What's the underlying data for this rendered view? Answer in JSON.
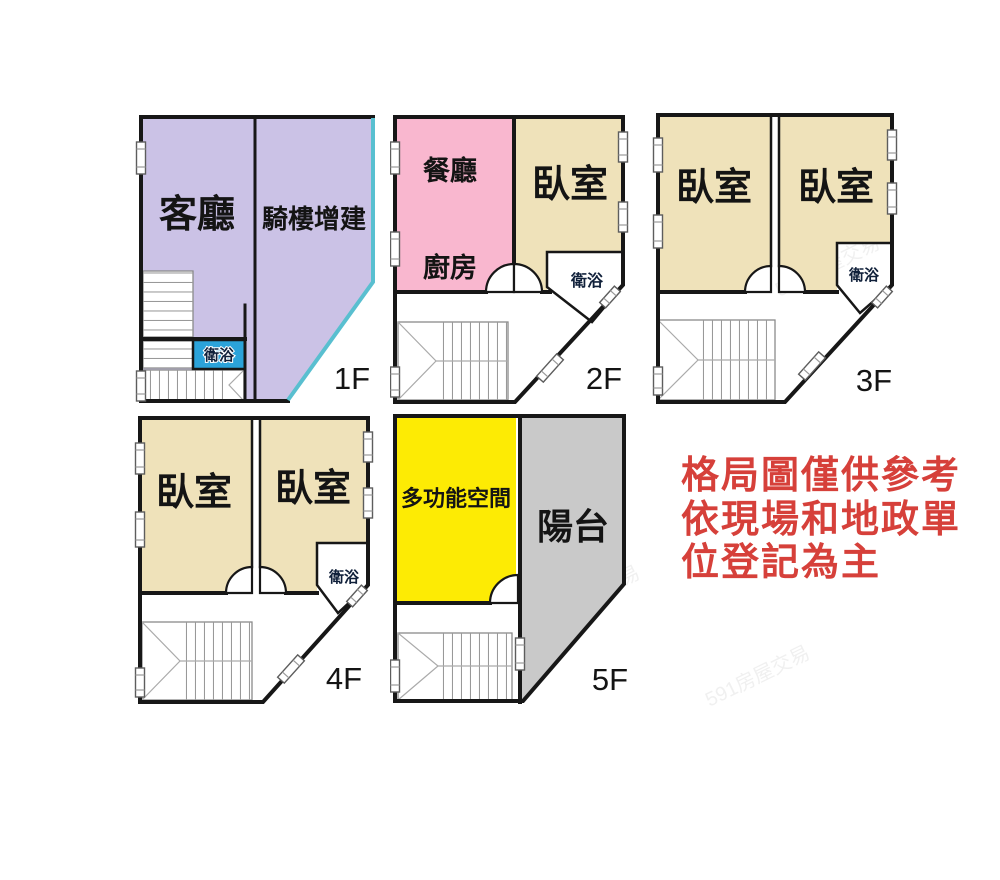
{
  "title": "apartment-floor-plans",
  "watermark": {
    "text": "591房屋交易"
  },
  "disclaimer": {
    "lines": [
      "格局圖僅供參考",
      "依現場和地政單",
      "位登記為主"
    ],
    "color": "#d6403a"
  },
  "colors": {
    "wall": "#171717",
    "living": "#cbc2e6",
    "arcade": "#cbc2e6",
    "arcade_edge": "#59bfd0",
    "dining": "#f9b7cf",
    "bedroom": "#efe2ba",
    "bath": "#2ba3da",
    "multi": "#fdeb04",
    "balcony": "#c9c9c9",
    "disclaimer_red": "#d6403a"
  },
  "floors": [
    {
      "label": "1F",
      "rooms": {
        "living": "客廳",
        "arcade": "騎樓增建",
        "bath": "衛浴"
      }
    },
    {
      "label": "2F",
      "rooms": {
        "dining": "餐廳",
        "kitchen": "廚房",
        "bedroom": "臥室",
        "bath": "衛浴"
      }
    },
    {
      "label": "3F",
      "rooms": {
        "bedroom_left": "臥室",
        "bedroom_right": "臥室",
        "bath": "衛浴"
      }
    },
    {
      "label": "4F",
      "rooms": {
        "bedroom_left": "臥室",
        "bedroom_right": "臥室",
        "bath": "衛浴"
      }
    },
    {
      "label": "5F",
      "rooms": {
        "multi": "多功能空間",
        "balcony": "陽台"
      }
    }
  ]
}
